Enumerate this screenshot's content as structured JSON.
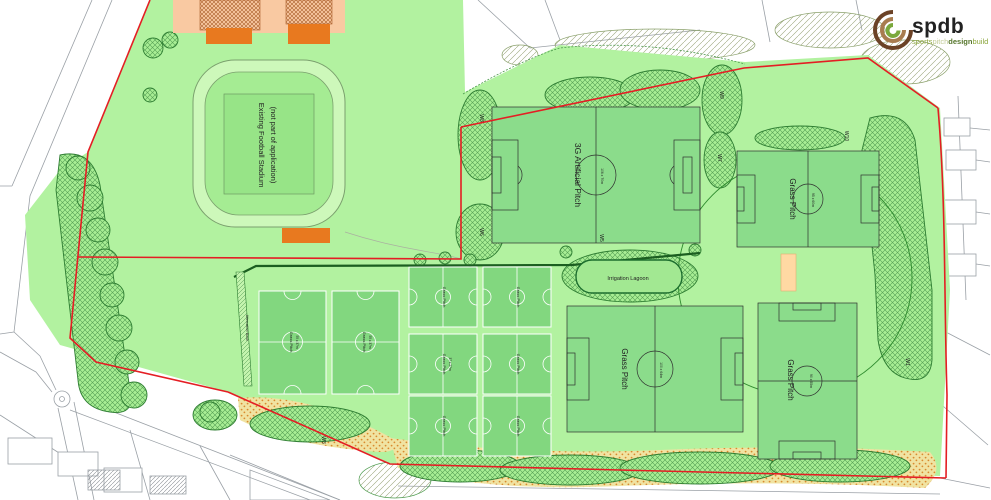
{
  "logo": {
    "brand": "spdb",
    "tag": [
      "sports",
      "pitch",
      "design",
      "build"
    ]
  },
  "labels": {
    "stadium1": "Existing Football Stadium",
    "stadium2": "(not part of application)",
    "artificial": "3G Artificial Pitch",
    "grass": "Grass Pitch",
    "lagoon": "Irrigation Lagoon",
    "attenuation": "Attenuation Basin"
  },
  "dims": {
    "artificial": "106 x 70m",
    "ne": "95 x 60m",
    "s": "100 x 64m",
    "se": "90 x 55m",
    "med": "55 x 37m",
    "mini": "37 x 27m"
  },
  "zones": {
    "w1": "W1",
    "w3": "W3",
    "w5": "W5",
    "w6": "W6",
    "w7": "W7",
    "w8": "W8",
    "w9": "W9",
    "w10": "W10"
  },
  "colors": {
    "site_green": "#b2f2a0",
    "pitch_green": "#8bdc8b",
    "mini_pitch_green": "#82d77f",
    "boundary_red": "#e41e24",
    "hedge_green": "#1b5e20",
    "lagoon_green": "#a2e892",
    "sand_orange": "#d98a2e",
    "building_orange": "#e8791f",
    "peach": "#f9c9a2",
    "pavilion": "#ffd9a3",
    "logo_green": "#9bb43f"
  }
}
